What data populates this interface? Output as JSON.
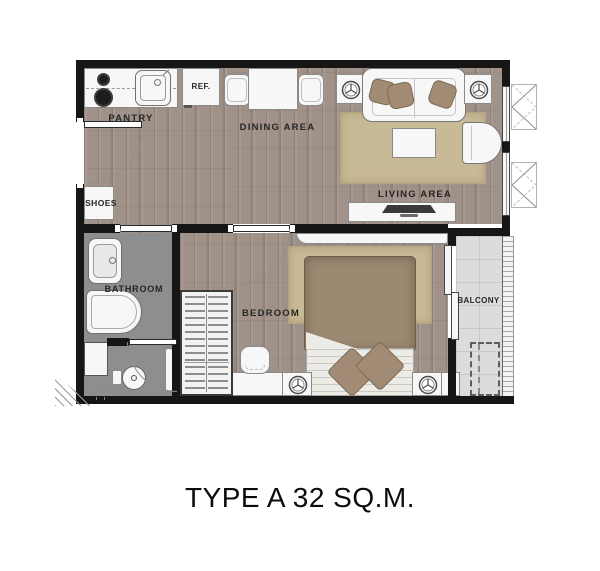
{
  "title": "TYPE A 32 SQ.M.",
  "rooms": {
    "pantry": {
      "label": "PANTRY"
    },
    "dining_area": {
      "label": "DINING AREA"
    },
    "living_area": {
      "label": "LIVING AREA"
    },
    "shoes": {
      "label": "SHOES"
    },
    "bathroom": {
      "label": "BATHROOM"
    },
    "bedroom": {
      "label": "BEDROOM"
    },
    "balcony": {
      "label": "BALCONY"
    }
  },
  "appliances": {
    "refrigerator": {
      "label": "REF."
    }
  },
  "colors": {
    "wall": "#161616",
    "wood_floor": "#a09289",
    "bathroom_floor": "#8e8e8e",
    "balcony_floor": "#dcdcda",
    "balcony_grid": "#c8c8c6",
    "rug": "#c9ba97",
    "bed_duvet": "#9c8770",
    "pillow": "#a18b74",
    "furniture": "#f7f7f7",
    "background": "#ffffff"
  }
}
